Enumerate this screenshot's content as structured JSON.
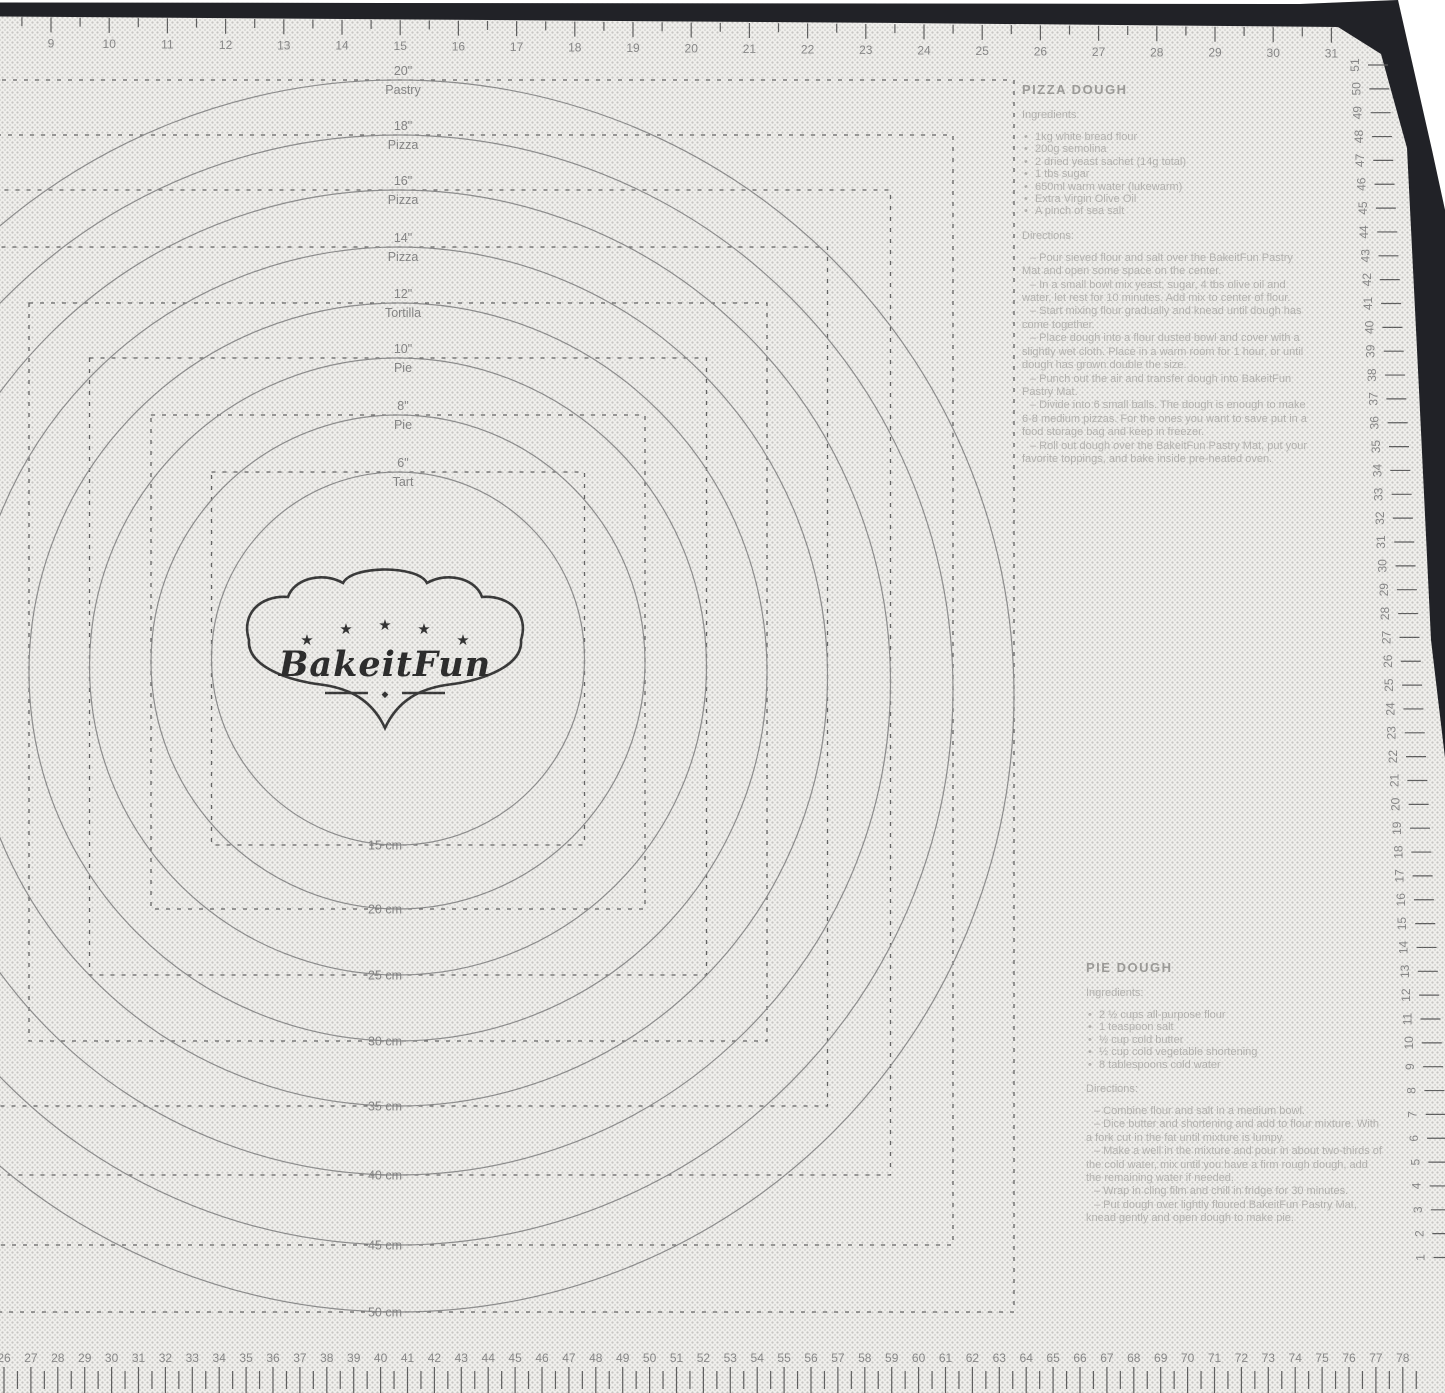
{
  "product": {
    "description": "BakeitFun pastry mat with measurements",
    "brand": "BakeitFun"
  },
  "colors": {
    "mat_base": "#f0efec",
    "mat_dots": "#c7c6c3",
    "border_black": "#212227",
    "print_gray": "#8a8a8a",
    "faint_text": "#b3b2af",
    "background_white": "#ffffff"
  },
  "logo": {
    "brand": "BakeitFun",
    "stars": 5,
    "star_icon": "star-icon",
    "diamond_icon": "diamond-icon"
  },
  "circles": [
    {
      "size_in": "20\"",
      "use": "Pastry",
      "size_cm": "50 cm"
    },
    {
      "size_in": "18\"",
      "use": "Pizza",
      "size_cm": "45 cm"
    },
    {
      "size_in": "16\"",
      "use": "Pizza",
      "size_cm": "40 cm"
    },
    {
      "size_in": "14\"",
      "use": "Pizza",
      "size_cm": "35 cm"
    },
    {
      "size_in": "12\"",
      "use": "Tortilla",
      "size_cm": "30 cm"
    },
    {
      "size_in": "10\"",
      "use": "Pie",
      "size_cm": "25 cm"
    },
    {
      "size_in": "8\"",
      "use": "Pie",
      "size_cm": "20 cm"
    },
    {
      "size_in": "6\"",
      "use": "Tart",
      "size_cm": "15 cm"
    }
  ],
  "rulers": {
    "top": {
      "unit": "inches",
      "values": [
        9,
        10,
        11,
        12,
        13,
        14,
        15,
        16,
        17,
        18,
        19,
        20,
        21,
        22,
        23,
        24,
        25,
        26,
        27,
        28,
        29,
        30,
        31
      ]
    },
    "bottom": {
      "unit": "cm",
      "values": [
        26,
        27,
        28,
        29,
        30,
        31,
        32,
        33,
        34,
        35,
        36,
        37,
        38,
        39,
        40,
        41,
        42,
        43,
        44,
        45,
        46,
        47,
        48,
        49,
        50,
        51,
        52,
        53,
        54,
        55,
        56,
        57,
        58,
        59,
        60,
        61,
        62,
        63,
        64,
        65,
        66,
        67,
        68,
        69,
        70,
        71,
        72,
        73,
        74,
        75,
        76,
        77,
        78
      ]
    },
    "right": {
      "unit": "cm",
      "values": [
        51,
        50,
        49,
        48,
        47,
        46,
        45,
        44,
        43,
        42,
        41,
        40,
        39,
        38,
        37,
        36,
        35,
        34,
        33,
        32,
        31,
        30,
        29,
        28,
        27,
        26,
        25,
        24,
        23,
        22,
        21,
        20,
        19,
        18,
        17,
        16,
        15,
        14,
        13,
        12,
        11,
        10,
        9,
        8,
        7,
        6,
        5,
        4,
        3,
        2,
        1
      ]
    }
  },
  "recipes": {
    "pizza": {
      "title": "PIZZA DOUGH",
      "ingredients_label": "Ingredients:",
      "ingredients": [
        "1kg white bread flour",
        "200g semolina",
        "2 dried yeast sachet (14g total)",
        "1 tbs sugar",
        "650ml warm water (lukewarm)",
        "Extra Virgin Olive Oil",
        "A pinch of sea salt"
      ],
      "directions_label": "Directions:",
      "directions": [
        "Pour sieved flour and salt over the BakeitFun Pastry Mat and open some space on the center.",
        "In a small bowl mix yeast, sugar, 4 tbs olive oil and water, let rest for 10 minutes. Add mix to center of flour.",
        "Start mixing flour gradually and knead until dough has come together.",
        "Place dough into a flour dusted bowl and cover with a slightly wet cloth. Place in a warm room for 1 hour, or until dough has grown double the size.",
        "Punch out the air and transfer dough into BakeitFun Pastry Mat.",
        "Divide into 6 small balls. The dough is enough to make 6-8 medium pizzas. For the ones you want to save put in a food storage bag and keep in freezer.",
        "Roll out dough over the BakeitFun Pastry Mat, put your favorite toppings, and bake inside pre-heated oven."
      ]
    },
    "pie": {
      "title": "PIE DOUGH",
      "ingredients_label": "Ingredients:",
      "ingredients": [
        "2 ½ cups all-purpose flour",
        "1 teaspoon salt",
        "½ cup cold butter",
        "½ cup cold vegetable shortening",
        "8 tablespoons cold water"
      ],
      "directions_label": "Directions:",
      "directions": [
        "Combine flour and salt in a medium bowl.",
        "Dice butter and shortening and add to flour mixture. With a fork cut in the fat until mixture is lumpy.",
        "Make a well in the mixture and pour in about two-thirds of the cold water, mix until you have a firm rough dough, add the remaining water if needed.",
        "Wrap in cling film and chill in fridge for 30 minutes.",
        "Put dough over lightly floured BakeitFun Pastry Mat, knead gently and open dough to make pie."
      ]
    }
  }
}
